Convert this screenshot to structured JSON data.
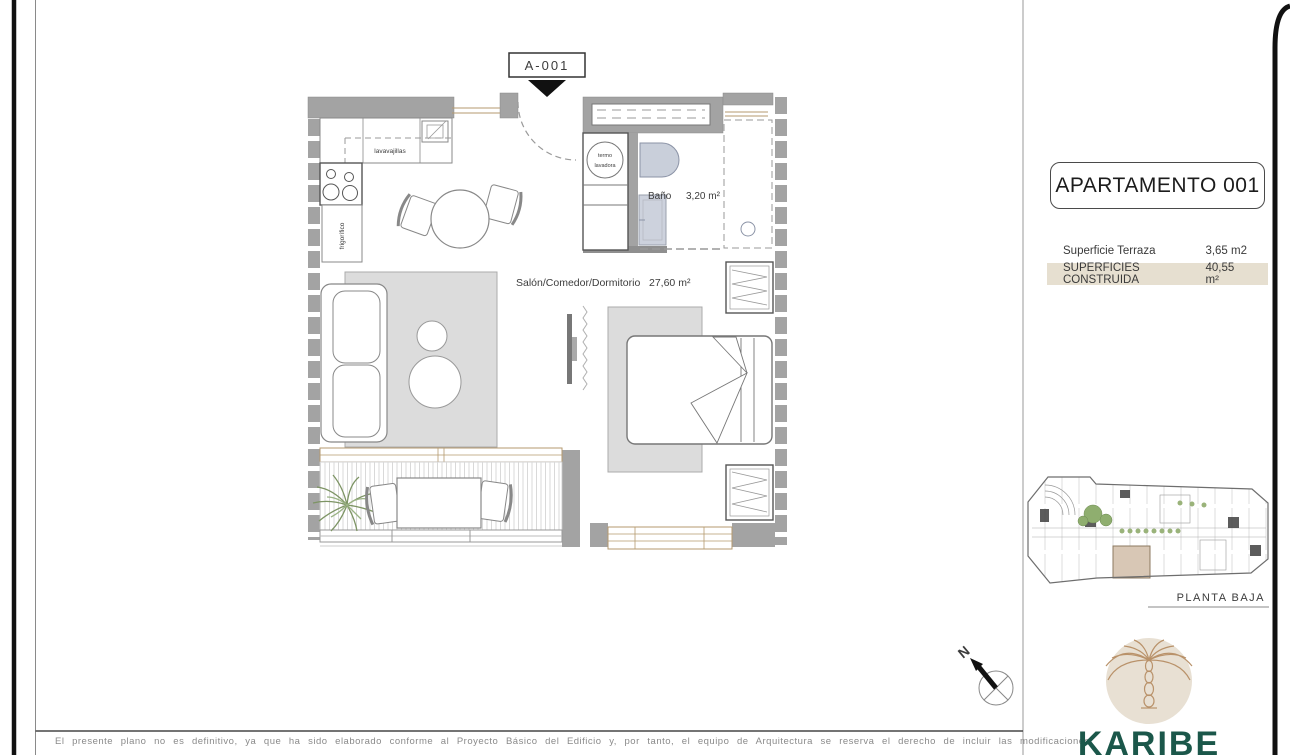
{
  "sheet": {
    "callout": "A-001",
    "compass": "N",
    "disclaimer": "El presente plano no es definitivo, ya que ha sido elaborado conforme al Proyecto Básico del Edificio y, por tanto, el equipo de Arquitectura se reserva el derecho de incluir las modificaciones"
  },
  "plan": {
    "rooms": {
      "salon": {
        "name": "Salón/Comedor/Dormitorio",
        "area": "27,60 m²"
      },
      "bano": {
        "name": "Baño",
        "area": "3,20 m²"
      }
    },
    "appliances": {
      "dishwasher": "lavavajillas",
      "fridge": "frigorífico",
      "heater_line1": "termo",
      "heater_line2": "lavadora"
    }
  },
  "panel": {
    "title": "APARTAMENTO 001",
    "rows": [
      {
        "label": "Superficie Terraza",
        "value": "3,65 m2",
        "highlight": false
      },
      {
        "label": "SUPERFICIES CONSTRUIDA",
        "value": "40,55 m²",
        "highlight": true
      }
    ],
    "keyplan_caption": "PLANTA BAJA"
  },
  "brand": {
    "name": "KARIBE"
  },
  "colors": {
    "wall_gray": "#a3a3a3",
    "rug_gray": "#dcdcdc",
    "highlight_row_beige": "#e6dfd0",
    "brand_green": "#1b574a",
    "logo_circle_beige": "#e8e0d3",
    "palm_tan": "#b9926a",
    "window_tan": "#b59a6f",
    "keyplan_unit_beige": "#d8c7b5",
    "plant_green": "#7d9464",
    "fixture_blue_gray": "#c9cfda"
  }
}
